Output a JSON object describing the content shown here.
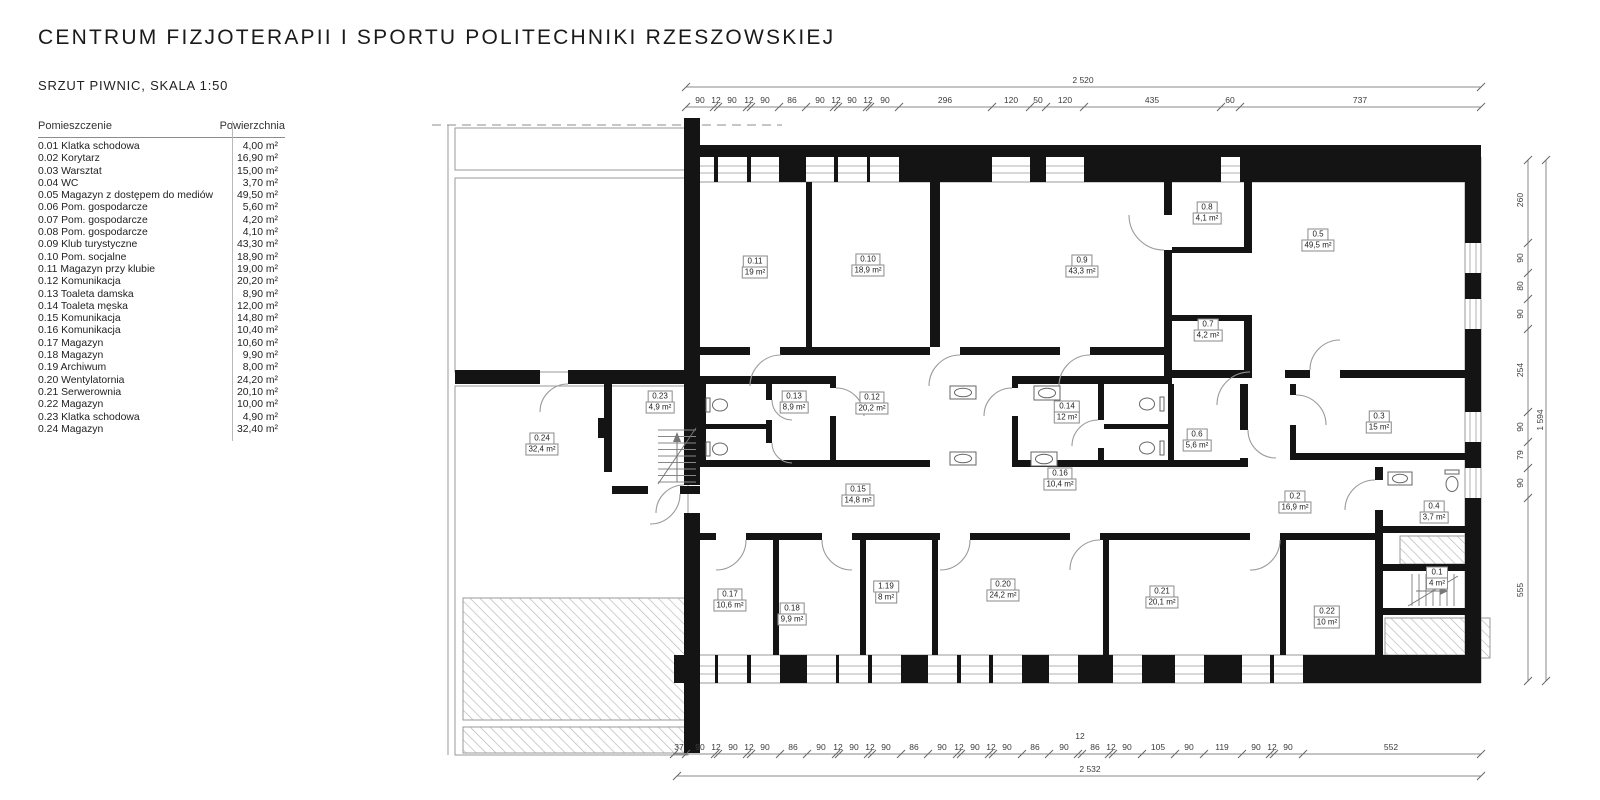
{
  "title": "CENTRUM FIZJOTERAPII I SPORTU POLITECHNIKI RZESZOWSKIEJ",
  "subtitle": "SRZUT PIWNIC, SKALA 1:50",
  "table": {
    "col_room": "Pomieszczenie",
    "col_area": "Powierzchnia",
    "rows": [
      [
        "0.01 Klatka schodowa",
        "4,00 m²"
      ],
      [
        "0.02 Korytarz",
        "16,90 m²"
      ],
      [
        "0.03 Warsztat",
        "15,00 m²"
      ],
      [
        "0.04 WC",
        "3,70 m²"
      ],
      [
        "0.05 Magazyn z dostępem do mediów",
        "49,50 m²"
      ],
      [
        "0.06 Pom. gospodarcze",
        "5,60 m²"
      ],
      [
        "0.07 Pom. gospodarcze",
        "4,20 m²"
      ],
      [
        "0.08 Pom. gospodarcze",
        "4,10 m²"
      ],
      [
        "0.09 Klub turystyczne",
        "43,30 m²"
      ],
      [
        "0.10 Pom. socjalne",
        "18,90 m²"
      ],
      [
        "0.11 Magazyn przy klubie",
        "19,00 m²"
      ],
      [
        "0.12 Komunikacja",
        "20,20 m²"
      ],
      [
        "0.13 Toaleta damska",
        "8,90 m²"
      ],
      [
        "0.14 Toaleta męska",
        "12,00 m²"
      ],
      [
        "0.15 Komunikacja",
        "14,80 m²"
      ],
      [
        "0.16 Komunikacja",
        "10,40 m²"
      ],
      [
        "0.17 Magazyn",
        "10,60 m²"
      ],
      [
        "0.18 Magazyn",
        "9,90 m²"
      ],
      [
        "0.19 Archiwum",
        "8,00 m²"
      ],
      [
        "0.20 Wentylatornia",
        "24,20 m²"
      ],
      [
        "0.21 Serwerownia",
        "20,10 m²"
      ],
      [
        "0.22 Magazyn",
        "10,00 m²"
      ],
      [
        "0.23 Klatka schodowa",
        "4,90 m²"
      ],
      [
        "0.24 Magazyn",
        "32,40 m²"
      ]
    ]
  },
  "plan": {
    "rooms": [
      {
        "id": "0.11",
        "area": "19 m²",
        "x": 755,
        "y": 267
      },
      {
        "id": "0.10",
        "area": "18,9 m²",
        "x": 868,
        "y": 265
      },
      {
        "id": "0.9",
        "area": "43,3 m²",
        "x": 1082,
        "y": 266
      },
      {
        "id": "0.8",
        "area": "4,1 m²",
        "x": 1207,
        "y": 213
      },
      {
        "id": "0.5",
        "area": "49,5 m²",
        "x": 1318,
        "y": 240
      },
      {
        "id": "0.7",
        "area": "4,2 m²",
        "x": 1208,
        "y": 330
      },
      {
        "id": "0.24",
        "area": "32,4 m²",
        "x": 542,
        "y": 444
      },
      {
        "id": "0.23",
        "area": "4,9 m²",
        "x": 660,
        "y": 402
      },
      {
        "id": "0.13",
        "area": "8,9 m²",
        "x": 794,
        "y": 402
      },
      {
        "id": "0.12",
        "area": "20,2 m²",
        "x": 872,
        "y": 403
      },
      {
        "id": "0.14",
        "area": "12 m²",
        "x": 1067,
        "y": 412
      },
      {
        "id": "0.6",
        "area": "5,6 m²",
        "x": 1197,
        "y": 440
      },
      {
        "id": "0.3",
        "area": "15 m²",
        "x": 1379,
        "y": 422
      },
      {
        "id": "0.15",
        "area": "14,8 m²",
        "x": 858,
        "y": 495
      },
      {
        "id": "0.16",
        "area": "10,4 m²",
        "x": 1060,
        "y": 479
      },
      {
        "id": "0.2",
        "area": "16,9 m²",
        "x": 1295,
        "y": 502
      },
      {
        "id": "0.4",
        "area": "3,7 m²",
        "x": 1434,
        "y": 512
      },
      {
        "id": "0.17",
        "area": "10,6 m²",
        "x": 730,
        "y": 600
      },
      {
        "id": "0.18",
        "area": "9,9 m²",
        "x": 792,
        "y": 614
      },
      {
        "id": "1.19",
        "area": "8 m²",
        "x": 886,
        "y": 592
      },
      {
        "id": "0.20",
        "area": "24,2 m²",
        "x": 1003,
        "y": 590
      },
      {
        "id": "0.21",
        "area": "20,1 m²",
        "x": 1162,
        "y": 597
      },
      {
        "id": "0.22",
        "area": "10 m²",
        "x": 1327,
        "y": 617
      },
      {
        "id": "0.1",
        "area": "4 m²",
        "x": 1437,
        "y": 578
      }
    ],
    "windows": {
      "top": [
        [
          686,
          714
        ],
        [
          718,
          747
        ],
        [
          751,
          779
        ],
        [
          806,
          834
        ],
        [
          838,
          867
        ],
        [
          870,
          899
        ],
        [
          992,
          1030
        ],
        [
          1046,
          1084
        ],
        [
          1221,
          1240
        ]
      ],
      "top_piers": [
        [
          714,
          718
        ],
        [
          747,
          751
        ],
        [
          779,
          806
        ],
        [
          834,
          838
        ],
        [
          867,
          870
        ],
        [
          899,
          992
        ],
        [
          1030,
          1046
        ],
        [
          1084,
          1221
        ],
        [
          1240,
          1481
        ]
      ],
      "bottom": [
        [
          686,
          715
        ],
        [
          718,
          747
        ],
        [
          751,
          780
        ],
        [
          807,
          836
        ],
        [
          839,
          868
        ],
        [
          872,
          901
        ],
        [
          928,
          957
        ],
        [
          961,
          989
        ],
        [
          993,
          1022
        ],
        [
          1049,
          1078
        ],
        [
          1113,
          1142
        ],
        [
          1175,
          1204
        ],
        [
          1242,
          1270
        ],
        [
          1274,
          1303
        ]
      ],
      "bottom_piers": [
        [
          674,
          686
        ],
        [
          715,
          718
        ],
        [
          747,
          751
        ],
        [
          780,
          807
        ],
        [
          836,
          839
        ],
        [
          868,
          872
        ],
        [
          901,
          928
        ],
        [
          957,
          961
        ],
        [
          989,
          993
        ],
        [
          1022,
          1049
        ],
        [
          1078,
          1113
        ],
        [
          1142,
          1175
        ],
        [
          1204,
          1242
        ],
        [
          1270,
          1274
        ],
        [
          1303,
          1481
        ]
      ],
      "right": [
        [
          243,
          273
        ],
        [
          299,
          329
        ],
        [
          412,
          442
        ],
        [
          468,
          498
        ]
      ],
      "right_piers": [
        [
          157,
          243
        ],
        [
          273,
          299
        ],
        [
          329,
          412
        ],
        [
          442,
          468
        ],
        [
          498,
          683
        ]
      ]
    }
  },
  "dims": {
    "top": {
      "total": {
        "v": "2 520",
        "x": 1083,
        "y": 85
      },
      "segments": [
        {
          "v": "90",
          "x": 700
        },
        {
          "v": "12",
          "x": 716
        },
        {
          "v": "90",
          "x": 732
        },
        {
          "v": "12",
          "x": 749
        },
        {
          "v": "90",
          "x": 765
        },
        {
          "v": "86",
          "x": 792
        },
        {
          "v": "90",
          "x": 820
        },
        {
          "v": "12",
          "x": 836
        },
        {
          "v": "90",
          "x": 852
        },
        {
          "v": "12",
          "x": 868
        },
        {
          "v": "90",
          "x": 885
        },
        {
          "v": "296",
          "x": 945
        },
        {
          "v": "120",
          "x": 1011
        },
        {
          "v": "50",
          "x": 1038
        },
        {
          "v": "120",
          "x": 1065
        },
        {
          "v": "435",
          "x": 1152
        },
        {
          "v": "60",
          "x": 1230
        },
        {
          "v": "737",
          "x": 1360
        }
      ],
      "boundaries": [
        686,
        714,
        718,
        747,
        751,
        779,
        806,
        834,
        838,
        867,
        870,
        899,
        992,
        1030,
        1046,
        1084,
        1221,
        1240,
        1481
      ],
      "label_y": 105,
      "line_y": 107,
      "total_line_y": 87
    },
    "bottom": {
      "total": {
        "v": "2 532",
        "x": 1090,
        "y": 774
      },
      "extra": {
        "v": "12",
        "x": 1080,
        "y": 741
      },
      "segments": [
        {
          "v": "37",
          "x": 679
        },
        {
          "v": "90",
          "x": 700
        },
        {
          "v": "12",
          "x": 716
        },
        {
          "v": "90",
          "x": 733
        },
        {
          "v": "12",
          "x": 749
        },
        {
          "v": "90",
          "x": 765
        },
        {
          "v": "86",
          "x": 793
        },
        {
          "v": "90",
          "x": 821
        },
        {
          "v": "12",
          "x": 838
        },
        {
          "v": "90",
          "x": 854
        },
        {
          "v": "12",
          "x": 870
        },
        {
          "v": "90",
          "x": 886
        },
        {
          "v": "86",
          "x": 914
        },
        {
          "v": "90",
          "x": 942
        },
        {
          "v": "12",
          "x": 959
        },
        {
          "v": "90",
          "x": 975
        },
        {
          "v": "12",
          "x": 991
        },
        {
          "v": "90",
          "x": 1007
        },
        {
          "v": "86",
          "x": 1035
        },
        {
          "v": "90",
          "x": 1064
        },
        {
          "v": "86",
          "x": 1095
        },
        {
          "v": "12",
          "x": 1111
        },
        {
          "v": "90",
          "x": 1127
        },
        {
          "v": "105",
          "x": 1158
        },
        {
          "v": "90",
          "x": 1189
        },
        {
          "v": "119",
          "x": 1222
        },
        {
          "v": "90",
          "x": 1256
        },
        {
          "v": "12",
          "x": 1272
        },
        {
          "v": "90",
          "x": 1288
        },
        {
          "v": "552",
          "x": 1391
        }
      ],
      "boundaries": [
        674,
        686,
        715,
        718,
        747,
        751,
        780,
        807,
        836,
        839,
        868,
        872,
        901,
        928,
        957,
        961,
        989,
        993,
        1022,
        1049,
        1078,
        1082,
        1109,
        1113,
        1142,
        1175,
        1204,
        1242,
        1270,
        1274,
        1303,
        1481
      ],
      "label_y": 752,
      "line_y": 754,
      "total_line_y": 776
    },
    "right": {
      "total": {
        "v": "1 594",
        "x": 1540,
        "y": 420
      },
      "segments": [
        {
          "v": "260",
          "y": 200
        },
        {
          "v": "90",
          "y": 258
        },
        {
          "v": "80",
          "y": 286
        },
        {
          "v": "90",
          "y": 314
        },
        {
          "v": "254",
          "y": 370
        },
        {
          "v": "90",
          "y": 427
        },
        {
          "v": "79",
          "y": 455
        },
        {
          "v": "90",
          "y": 483
        },
        {
          "v": "555",
          "y": 590
        }
      ],
      "boundaries": [
        160,
        243,
        273,
        299,
        329,
        412,
        442,
        468,
        498,
        681
      ],
      "label_x": 1520,
      "line_x": 1528,
      "total_line_x": 1546
    }
  }
}
